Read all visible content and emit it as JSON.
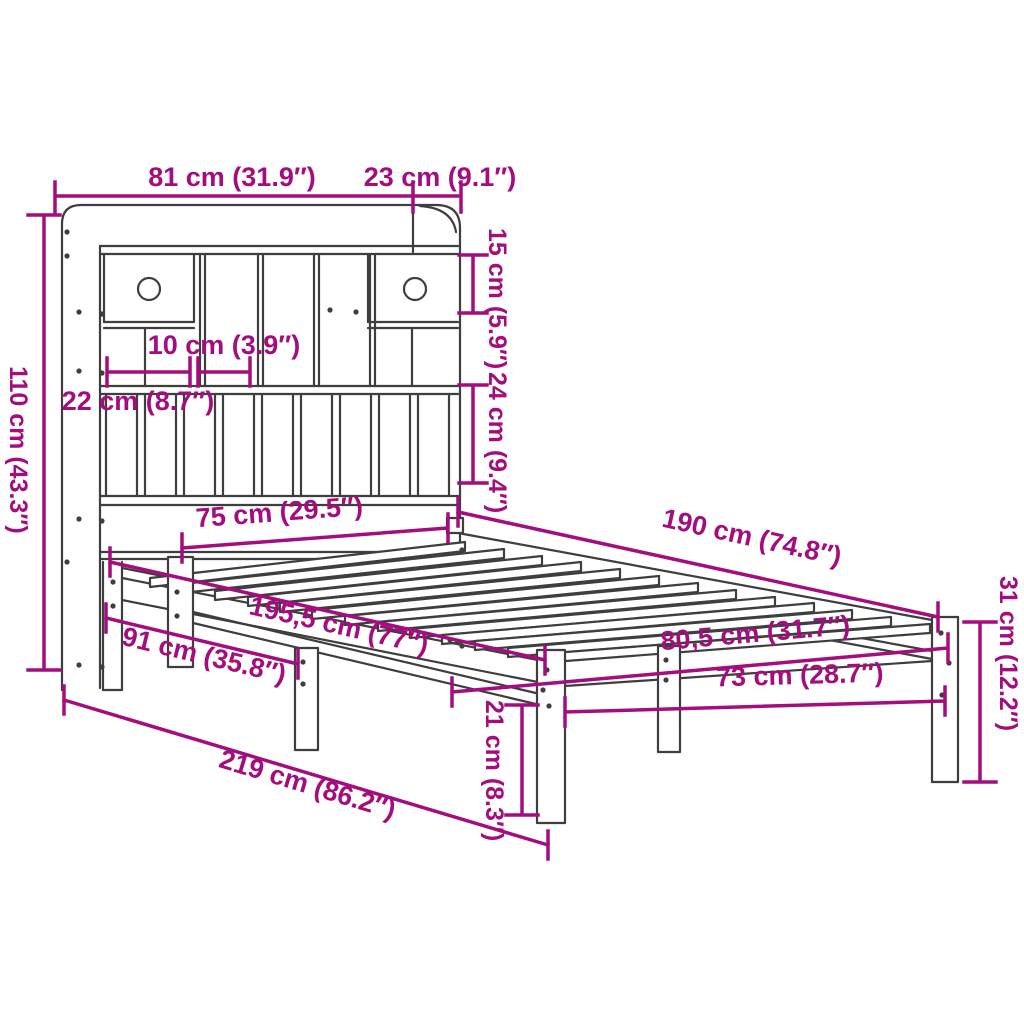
{
  "diagram": {
    "subject": "bookcase-bed-with-storage-headboard-dimension-diagram",
    "units": [
      "cm",
      "inch"
    ],
    "colors": {
      "dimension_accent": "#A30D7E",
      "structure_line": "#3E3E3E",
      "background": "#FFFFFF"
    },
    "dimensions": [
      {
        "id": "headboard-width",
        "label": "81 cm (31.9″)",
        "cm": 81,
        "inch": 31.9
      },
      {
        "id": "headboard-depth",
        "label": "23 cm (9.1″)",
        "cm": 23,
        "inch": 9.1
      },
      {
        "id": "top-shelf-height",
        "label": "15 cm (5.9″)",
        "cm": 15,
        "inch": 5.9
      },
      {
        "id": "headboard-height",
        "label": "110 cm (43.3″)",
        "cm": 110,
        "inch": 43.3
      },
      {
        "id": "cubby-width",
        "label": "10 cm (3.9″)",
        "cm": 10,
        "inch": 3.9
      },
      {
        "id": "drawer-width",
        "label": "22 cm (8.7″)",
        "cm": 22,
        "inch": 8.7
      },
      {
        "id": "lower-shelf-height",
        "label": "24 cm (9.4″)",
        "cm": 24,
        "inch": 9.4
      },
      {
        "id": "inner-width-head",
        "label": "75 cm (29.5″)",
        "cm": 75,
        "inch": 29.5
      },
      {
        "id": "bed-length",
        "label": "190 cm (74.8″)",
        "cm": 190,
        "inch": 74.8
      },
      {
        "id": "frame-length",
        "label": "195,5 cm (77″)",
        "cm": 195.5,
        "inch": 77
      },
      {
        "id": "head-to-middle-leg",
        "label": "91 cm (35.8″)",
        "cm": 91,
        "inch": 35.8
      },
      {
        "id": "outer-width-foot",
        "label": "80,5 cm (31.7″)",
        "cm": 80.5,
        "inch": 31.7
      },
      {
        "id": "inner-width-foot",
        "label": "73 cm (28.7″)",
        "cm": 73,
        "inch": 28.7
      },
      {
        "id": "total-length",
        "label": "219 cm (86.2″)",
        "cm": 219,
        "inch": 86.2
      },
      {
        "id": "foot-end-height",
        "label": "31 cm (12.2″)",
        "cm": 31,
        "inch": 12.2
      },
      {
        "id": "under-bed-clearance",
        "label": "21 cm (8.3″)",
        "cm": 21,
        "inch": 8.3
      }
    ]
  }
}
